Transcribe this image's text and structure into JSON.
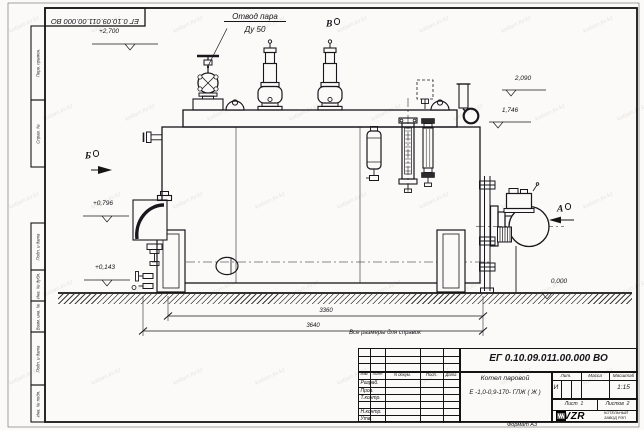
{
  "watermark": "kotlam.kv.kz",
  "frame": {
    "top_stamp": "ЕГ 0.10.09.011.00.000 ВО",
    "side_boxes": [
      "Перв. примен.",
      "Справ. №",
      "Подп. и дата",
      "Инв. № дубл.",
      "Взам. инв. №",
      "Подп. и дата",
      "Инв. № подл."
    ],
    "format_note": "Формат А3"
  },
  "annotations": {
    "steam_outlet_line1": "Отвод пара",
    "steam_outlet_line2": "Ду 50",
    "view_a": "А",
    "view_b": "Б",
    "view_v": "В",
    "elev_2700": "+2,700",
    "elev_2090": "2,090",
    "elev_1746": "1,746",
    "elev_0796": "+0,796",
    "elev_0143": "+0,143",
    "elev_0000": "0,000",
    "dim_3360": "3360",
    "dim_3640": "3640",
    "note": "Все размеры для справок"
  },
  "title_block": {
    "doc_number": "ЕГ 0.10.09.011.00.000 ВО",
    "product_name_line1": "Котел паровой",
    "product_name_line2": "Е -1,0-0,9-170- ГЛЖ ( Ж )",
    "col_izm": "Изм.",
    "col_list": "Лист",
    "col_doc": "N докум.",
    "col_podp": "Подп.",
    "col_data": "Дата",
    "row_razrab": "Разраб.",
    "row_prov": "Пров.",
    "row_tkontr": "Т.контр.",
    "row_nkontr": "Н.контр.",
    "row_utv": "Утв.",
    "lit_header": "Лит.",
    "mass_header": "Масса",
    "scale_header": "Масштаб",
    "lit_value": "И",
    "scale_value": "1:15",
    "sheet_label": "Лист",
    "sheet_value": "1",
    "sheets_label": "Листов",
    "sheets_value": "2",
    "logo_text": "KVZR",
    "company_line1": "КОТЕЛЬНЫЙ",
    "company_line2": "ЗАВОД РЭП"
  }
}
